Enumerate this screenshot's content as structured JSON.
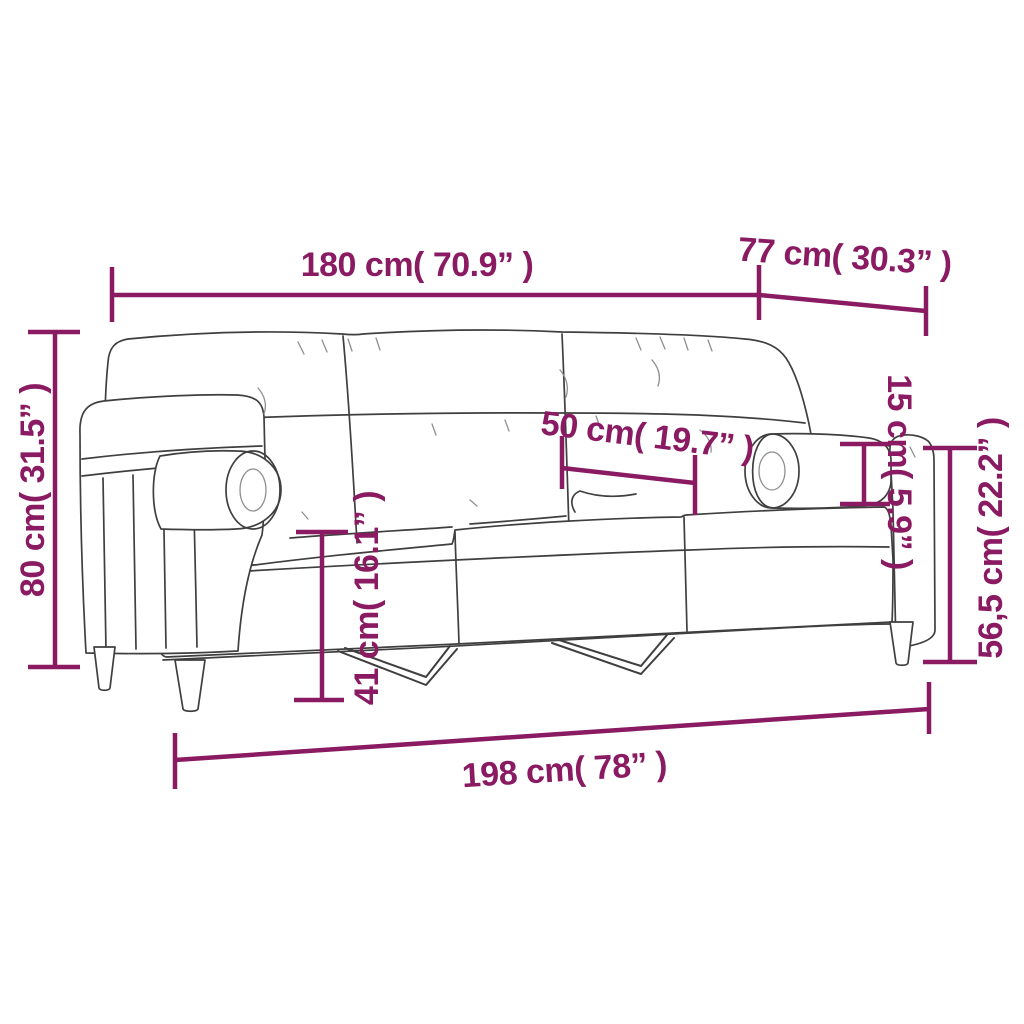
{
  "colors": {
    "accent": "#8A1A62",
    "line": "#3F3F3F",
    "texture": "#8F8F8F",
    "background": "#FFFFFF"
  },
  "dimensions": {
    "back_width": {
      "label": "180 cm( 70.9” )",
      "value_cm": 180,
      "value_in": 70.9
    },
    "depth": {
      "label": "77 cm( 30.3” )",
      "value_cm": 77,
      "value_in": 30.3
    },
    "height": {
      "label": "80 cm( 31.5” )",
      "value_cm": 80,
      "value_in": 31.5
    },
    "seat_depth": {
      "label": "50 cm( 19.7” )",
      "value_cm": 50,
      "value_in": 19.7
    },
    "pillow_diameter": {
      "label": "15 cm( 5.9” )",
      "value_cm": 15,
      "value_in": 5.9
    },
    "armrest_height": {
      "label": "56,5 cm( 22.2” )",
      "value_cm": 56.5,
      "value_in": 22.2
    },
    "seat_height": {
      "label": "41 cm( 16.1” )",
      "value_cm": 41,
      "value_in": 16.1
    },
    "total_width": {
      "label": "198 cm( 78” )",
      "value_cm": 198,
      "value_in": 78
    }
  }
}
